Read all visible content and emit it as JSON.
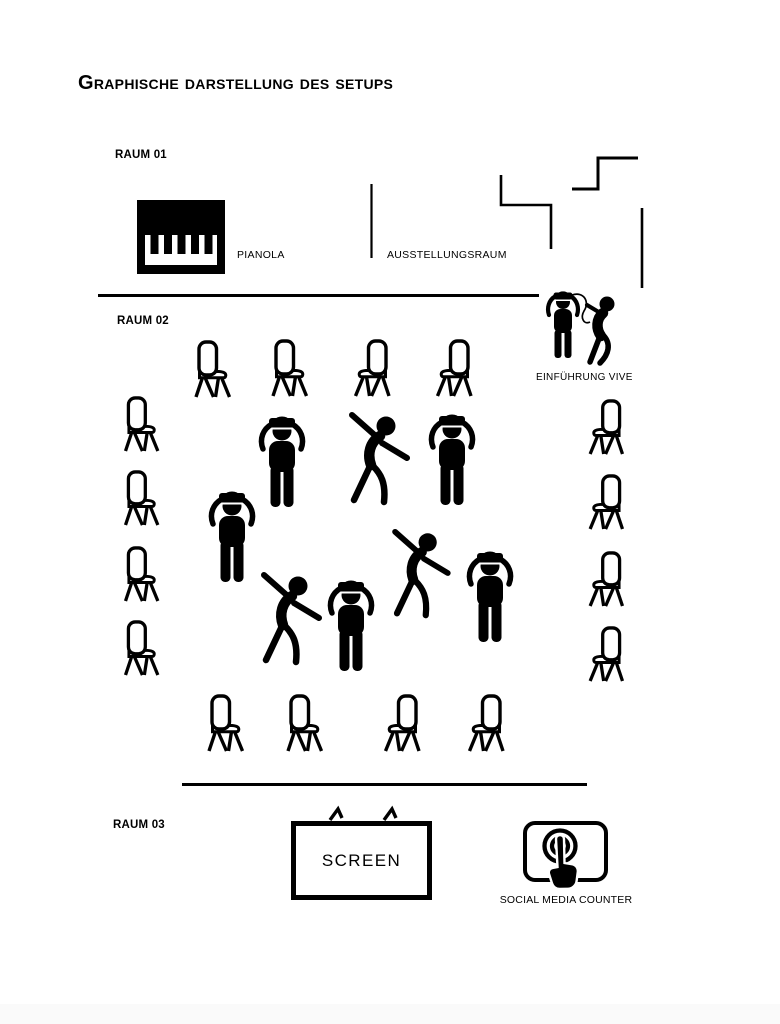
{
  "page": {
    "title": "Graphische Darstellung des Setups"
  },
  "rooms": [
    {
      "id": "raum-01",
      "label": "RAUM 01"
    },
    {
      "id": "raum-02",
      "label": "RAUM 02"
    },
    {
      "id": "raum-03",
      "label": "RAUM 03"
    }
  ],
  "labels": {
    "pianola": "PIANOLA",
    "ausstellungsraum": "AUSSTELLUNGSRAUM",
    "einfuehrung_vive": "EINFÜHRUNG VIVE",
    "screen": "SCREEN",
    "social_media_counter": "SOCIAL MEDIA COUNTER"
  },
  "icons": {
    "pianola": "piano-keyboard-icon",
    "chair": "chair-icon",
    "vr_user": "person-wearing-vr-headset-icon",
    "dancer": "dancing-person-icon",
    "vive_intro": "vr-headset-assistance-pair-icon",
    "screen": "tv-screen-icon",
    "social_media_counter": "touch-tap-hand-icon"
  },
  "figures": {
    "chair_count": 16,
    "vr_user_count": 5,
    "dancer_count": 3
  },
  "colors": {
    "ink": "#000000",
    "background": "#ffffff"
  }
}
